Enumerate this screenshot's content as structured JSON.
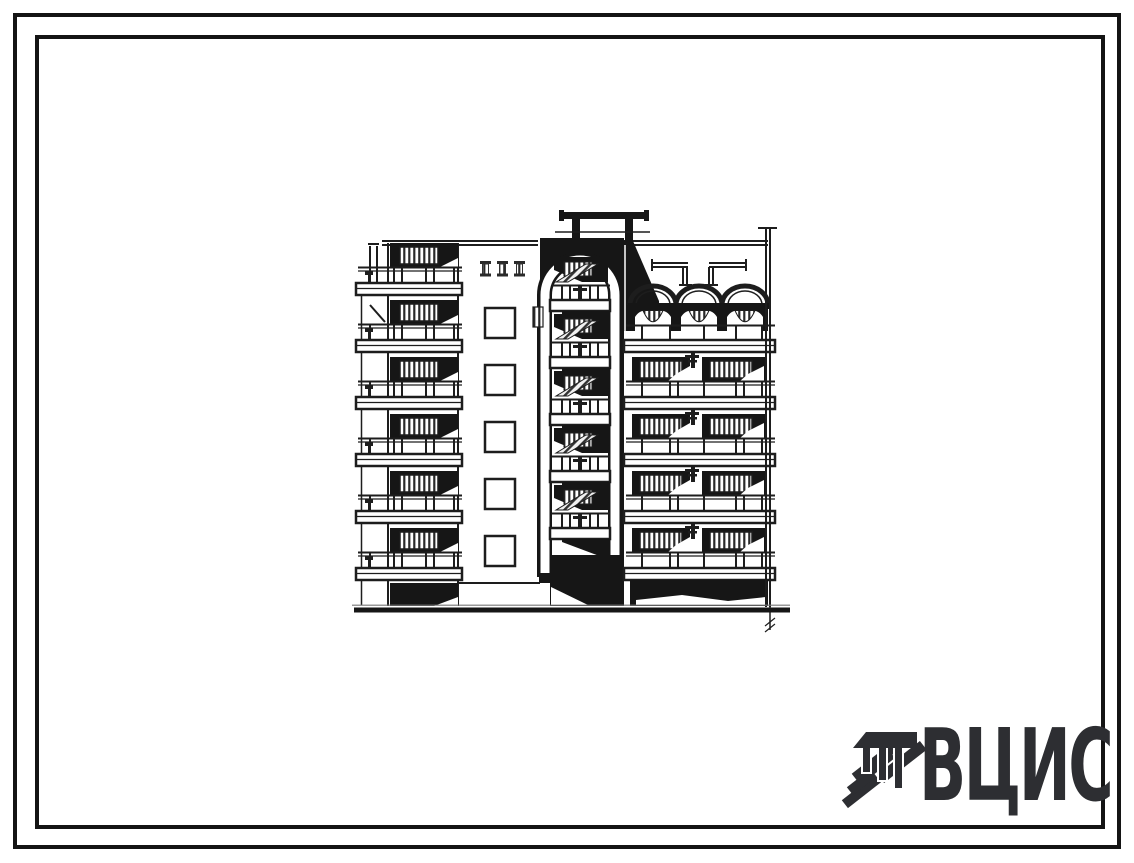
{
  "page": {
    "background": "#ffffff",
    "frame_color": "#141414"
  },
  "artwork": {
    "type": "architectural elevation drawing",
    "subject": "Six-storey residential block end elevation with central arched stairwell, stacked balconies and vaulted roof canopies",
    "ink_color": "#1d1d1d",
    "floors": 6
  },
  "logo": {
    "text": "ВЦИС",
    "color": "#2d2e32"
  }
}
